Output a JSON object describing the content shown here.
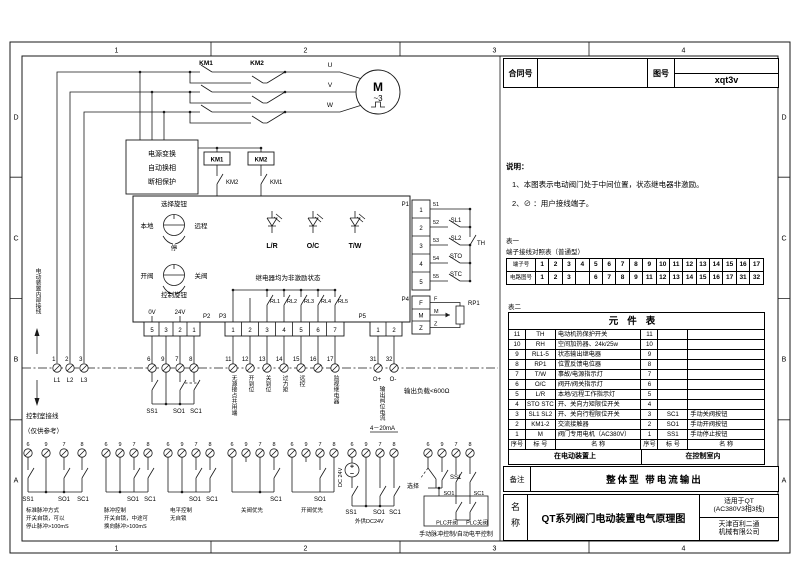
{
  "sheet": {
    "border_cols": [
      "1",
      "2",
      "3",
      "4"
    ],
    "border_rows": [
      "D",
      "C",
      "B",
      "A"
    ]
  },
  "titleblock": {
    "contract_label": "合同号",
    "contract_value": "",
    "drawing_label": "图号",
    "drawing_value": "xqt3v"
  },
  "notes": {
    "title": "说明：",
    "items": [
      "1、本图表示电动阀门处于中间位置，状态继电器非激励。",
      "2、⊘ ：用户接线端子。"
    ]
  },
  "table1": {
    "label": "表一",
    "title": "端子接线对照表（普通型）",
    "rows": [
      {
        "header": "端子号",
        "cells": [
          "1",
          "2",
          "3",
          "4",
          "5",
          "6",
          "7",
          "8",
          "9",
          "10",
          "11",
          "12",
          "13",
          "14",
          "15",
          "16",
          "17"
        ]
      },
      {
        "header": "电路图号",
        "cells": [
          "1",
          "2",
          "3",
          "",
          "6",
          "7",
          "8",
          "9",
          "11",
          "12",
          "13",
          "14",
          "15",
          "16",
          "17",
          "31",
          "32"
        ]
      }
    ]
  },
  "table2": {
    "label": "表二",
    "title": "元件表",
    "rows": [
      [
        "11",
        "TH",
        "电动机热保护开关",
        "11",
        "",
        ""
      ],
      [
        "10",
        "RH",
        "空间加热器、24k/25w",
        "10",
        "",
        ""
      ],
      [
        "9",
        "RL1-5",
        "状态输出继电器",
        "9",
        "",
        ""
      ],
      [
        "8",
        "RP1",
        "位置反馈电位器",
        "8",
        "",
        ""
      ],
      [
        "7",
        "T/W",
        "事故/电源指示灯",
        "7",
        "",
        ""
      ],
      [
        "6",
        "O/C",
        "阀开/阀关指示灯",
        "6",
        "",
        ""
      ],
      [
        "5",
        "L/R",
        "本地/远程工作指示灯",
        "5",
        "",
        ""
      ],
      [
        "4",
        "STO STC",
        "开、关向力矩限位开关",
        "4",
        "",
        ""
      ],
      [
        "3",
        "SL1 SL2",
        "开、关向行程限位开关",
        "3",
        "SC1",
        "手动关阀按钮"
      ],
      [
        "2",
        "KM1-2",
        "交流接触器",
        "2",
        "SO1",
        "手动开阀按钮"
      ],
      [
        "1",
        "M",
        "阀门专用电机（AC380V）",
        "1",
        "SS1",
        "手动停止按钮"
      ]
    ],
    "footer": [
      "序号",
      "标 号",
      "名  称",
      "序号",
      "标 号",
      "名  称"
    ],
    "zones": [
      "在电动装置上",
      "在控制室内"
    ]
  },
  "remark": {
    "label": "备注",
    "value": "整体型 带电流输出"
  },
  "nameblock": {
    "label": "名称",
    "title": "QT系列阀门电动装置电气原理图",
    "apply_line1": "适用于QT",
    "apply_line2": "(AC380V3相3线)",
    "company_line1": "天津百利二通",
    "company_line2": "机械有限公司"
  },
  "schematic": {
    "km1": "KM1",
    "km2": "KM2",
    "phase_u": "U",
    "phase_v": "V",
    "phase_w": "W",
    "motor": "M",
    "motor_type": "~3",
    "psu_box": [
      "电源变换",
      "自动换相",
      "断相保护"
    ],
    "sel_knob": "选择旋钮",
    "local": "本地",
    "remote": "远程",
    "stop": "停",
    "open_valve": "开阀",
    "close_valve": "关阀",
    "ctrl_knob": "控制旋钮",
    "lr": "L/R",
    "oc": "O/C",
    "tw": "T/W",
    "relay_note": "继电器均为非激励状态",
    "rl": [
      "RL1",
      "RL2",
      "RL3",
      "RL4",
      "RL5"
    ],
    "p1": "P1",
    "p2": "P2",
    "p3": "P3",
    "p4": "P4",
    "p5": "P5",
    "p1_pins": [
      "1",
      "2",
      "3",
      "4",
      "5"
    ],
    "p1_wires": [
      "51",
      "52",
      "53",
      "54",
      "55"
    ],
    "sl1": "SL1",
    "sl2": "SL2",
    "sto": "STO",
    "stc": "STC",
    "th": "TH",
    "p4_pins": [
      "F",
      "M",
      "Z"
    ],
    "rp1": "RP1",
    "p2_pins": [
      "5",
      "3",
      "2",
      "1"
    ],
    "v0": "0V",
    "v24": "24V",
    "p3_pins": [
      "1",
      "2",
      "3",
      "4",
      "5",
      "6",
      "7"
    ],
    "p5_pins": [
      "1",
      "2"
    ],
    "term_power": [
      "1",
      "2",
      "3"
    ],
    "term_power_labels": [
      "L1",
      "L2",
      "L3"
    ],
    "term_ctrl": [
      "6",
      "9",
      "7",
      "8"
    ],
    "term_status": [
      "11",
      "12",
      "13",
      "14",
      "15",
      "16",
      "17"
    ],
    "term_status_labels": [
      "无源接点共用端",
      "开到位",
      "关到位",
      "过力矩",
      "远控",
      "",
      "监视继电器"
    ],
    "term_out": [
      "31",
      "32"
    ],
    "out_plus": "O+",
    "out_minus": "O-",
    "out_current_label": "输出阀位电流",
    "out_current_range": "4－20mA",
    "out_load": "输出负载<600Ω",
    "left_top_note": "电动装置内部接线",
    "left_bottom_note1": "控制室接线",
    "left_bottom_note2": "（仅供参考）",
    "ss1": "SS1",
    "so1": "SO1",
    "sc1": "SC1",
    "dc24": "DC 24V",
    "select": "选择",
    "plc_open": "PLC开阀",
    "plc_close": "PLC关阀",
    "groups": [
      {
        "labels": [
          "SS1",
          "SO1",
          "SC1"
        ],
        "caption": [
          "标准脉冲方式",
          "开关自锁，可以",
          "停止脉冲>100mS"
        ]
      },
      {
        "labels": [
          "SO1",
          "SC1"
        ],
        "caption": [
          "脉冲控制",
          "开关自锁，中途可",
          "换向脉冲>100mS"
        ]
      },
      {
        "labels": [
          "SO1",
          "SC1"
        ],
        "caption": [
          "电平控制",
          "无自锁"
        ]
      },
      {
        "labels": [
          "SC1"
        ],
        "caption": [
          "关阀优先"
        ]
      },
      {
        "labels": [
          "SO1"
        ],
        "caption": [
          "开阀优先"
        ]
      },
      {
        "labels": [
          "SS1",
          "SO1",
          "SC1"
        ],
        "caption": [
          "外供DC24V"
        ]
      },
      {
        "labels": [
          "选择",
          "SS1",
          "SO1",
          "SC1",
          "PLC开阀",
          "PLC关阀"
        ],
        "caption": [
          "手动脉冲控制/自动电平控制"
        ]
      }
    ]
  }
}
